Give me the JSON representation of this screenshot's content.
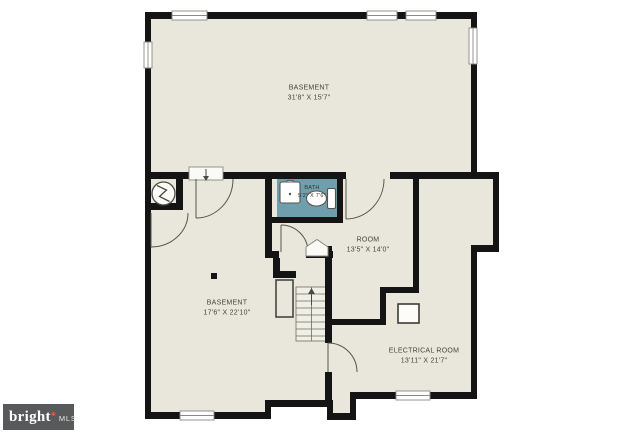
{
  "page": {
    "background": "#ffffff"
  },
  "floorplan": {
    "colors": {
      "floor_fill": "#e9e7dc",
      "wall": "#141414",
      "bath_fill": "#6f9fad",
      "label_text": "#45443c",
      "stairs_fill": "#f0efe6"
    },
    "rooms": [
      {
        "id": "basement-upper",
        "name": "BASEMENT",
        "dims": "31'8\" X 15'7\""
      },
      {
        "id": "bath",
        "name": "BATH",
        "dims": "5'2\" X 7'6\""
      },
      {
        "id": "room",
        "name": "ROOM",
        "dims": "13'5\" X 14'0\""
      },
      {
        "id": "basement-lower",
        "name": "BASEMENT",
        "dims": "17'6\" X 22'10\""
      },
      {
        "id": "electrical-room",
        "name": "ELECTRICAL ROOM",
        "dims": "13'11\" X 21'7\""
      }
    ],
    "icons": [
      {
        "name": "water-heater-icon",
        "shape": "circle-with-zigzag"
      },
      {
        "name": "stairs-up-arrow",
        "shape": "arrow-up"
      },
      {
        "name": "entry-arrow",
        "shape": "arrow-down"
      },
      {
        "name": "sink-icon",
        "shape": "square-basin"
      },
      {
        "name": "toilet-icon",
        "shape": "bowl-and-tank"
      },
      {
        "name": "electrical-unit-icon",
        "shape": "open-square"
      }
    ]
  },
  "logo": {
    "brand": "bright",
    "star": "✱",
    "suffix": "MLS",
    "bg_color": "#58595b",
    "star_color": "#e8583f"
  }
}
